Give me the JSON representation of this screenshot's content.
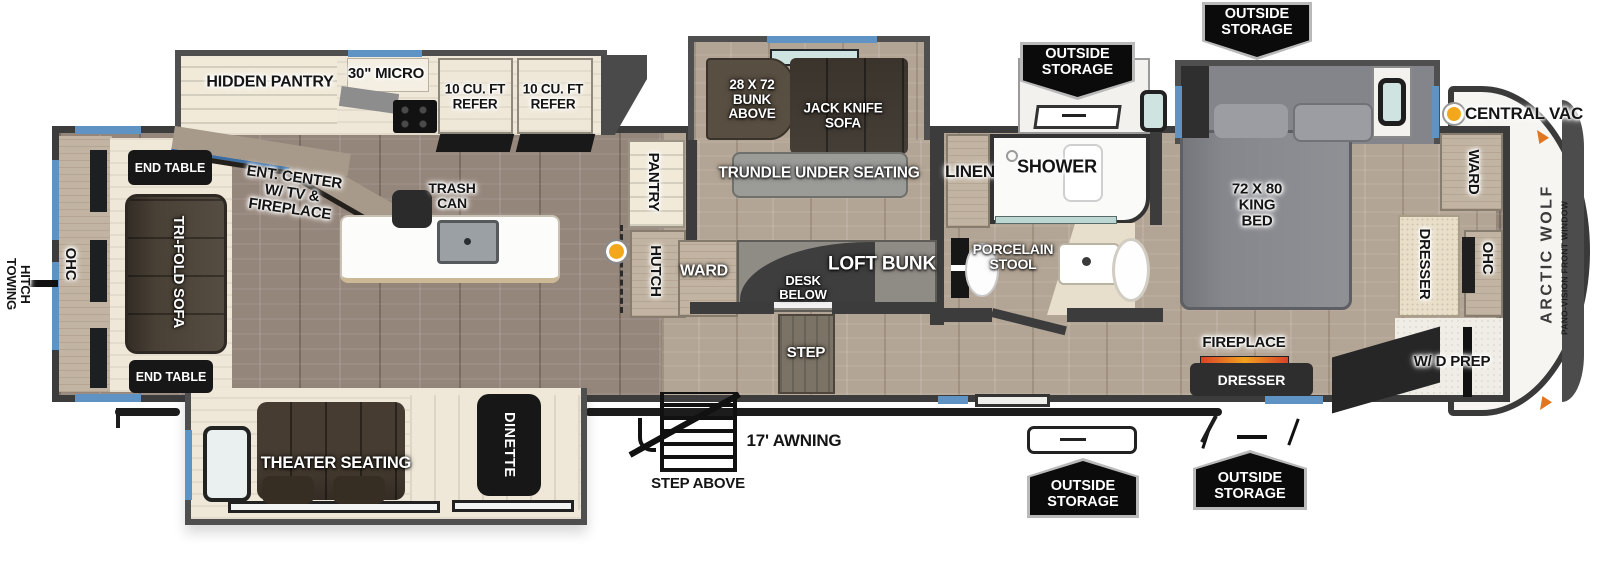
{
  "branding": {
    "model": "ARCTIC WOLF",
    "front_window": "PANO-VISION FRONT WINDOW"
  },
  "legend": {
    "central_vac": "CENTRAL VAC"
  },
  "storage_badge": "OUTSIDE\nSTORAGE",
  "exterior": {
    "towing_hitch": "TOWING\nHITCH",
    "awning": "17' AWNING",
    "step_above": "STEP ABOVE"
  },
  "living": {
    "ohc": "OHC",
    "end_table_top": "END TABLE",
    "end_table_bottom": "END TABLE",
    "tri_fold_sofa": "TRI-FOLD SOFA",
    "ent_center": "ENT. CENTER\nW/ TV &\nFIREPLACE",
    "theater_seating": "THEATER SEATING",
    "dinette": "DINETTE"
  },
  "kitchen": {
    "hidden_pantry": "HIDDEN PANTRY",
    "micro": "30\" MICRO",
    "refer_left": "10 CU. FT\nREFER",
    "refer_right": "10 CU. FT\nREFER",
    "trash_can": "TRASH\nCAN",
    "pantry": "PANTRY",
    "hutch": "HUTCH"
  },
  "bunk_room": {
    "bunk_above": "28 X 72\nBUNK\nABOVE",
    "jack_knife_sofa": "JACK KNIFE\nSOFA",
    "trundle": "TRUNDLE UNDER SEATING",
    "ward": "WARD",
    "desk_below": "DESK\nBELOW",
    "loft_bunk": "LOFT BUNK",
    "step": "STEP"
  },
  "bathroom": {
    "linen": "LINEN",
    "shower": "SHOWER",
    "porcelain_stool": "PORCELAIN\nSTOOL"
  },
  "bedroom": {
    "king_bed": "72 X 80\nKING\nBED",
    "fireplace": "FIREPLACE",
    "dresser_rear": "DRESSER",
    "ward_front": "WARD",
    "dresser_front": "DRESSER",
    "ohc_front": "OHC",
    "wd_prep": "W/ D PREP"
  },
  "colors": {
    "window_blue": "#5e93c4",
    "window_teal": "#cfe3e0",
    "vac_dot_orange": "#f3a81c",
    "marker_orange": "#e0761f",
    "badge_bg": "#0b0b0b",
    "wall_gray": "#3c3c3c"
  }
}
